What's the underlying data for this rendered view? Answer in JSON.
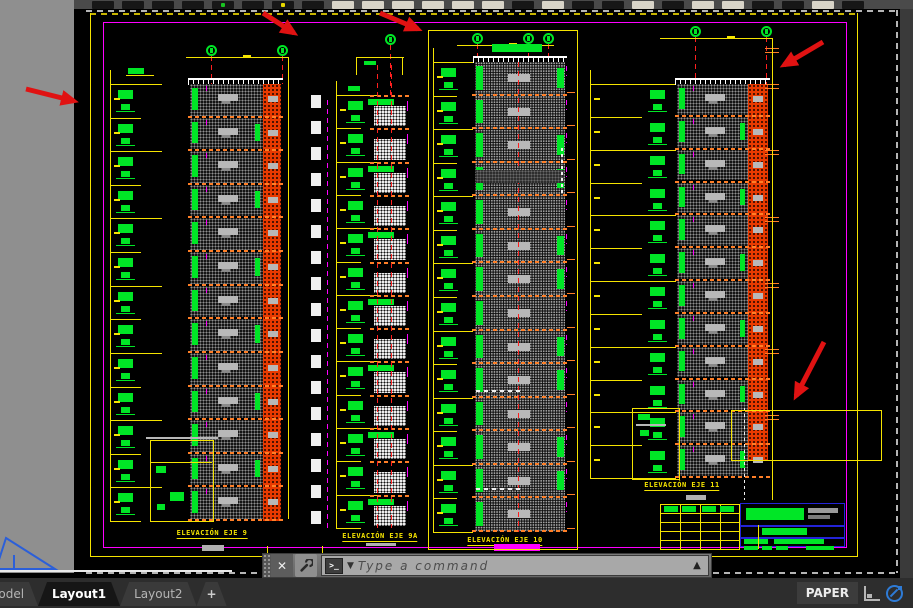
{
  "palette": {
    "yellow": "#f5e400",
    "green": "#00e626",
    "magenta": "#ff00ff",
    "orange": "#ff7f27",
    "red": "#ff1f1f",
    "arrow": "#e01212",
    "blue": "#2323d8",
    "gray_sill": "#b8b8b8",
    "orange_fill": "#e83a00"
  },
  "drawings": [
    {
      "id": "eje9",
      "label": "ELEVACIÓN EJE 9",
      "floors": 13,
      "axis_bubbles": 2
    },
    {
      "id": "eje9a",
      "label": "ELEVACIÓN EJE 9A",
      "floors": 13,
      "axis_bubbles": 1
    },
    {
      "id": "eje10",
      "label": "ELEVACIÓN EJE 10",
      "floors": 14,
      "axis_bubbles": 3
    },
    {
      "id": "eje11",
      "label": "ELEVACIÓN EJE 11",
      "floors": 12,
      "axis_bubbles": 2
    }
  ],
  "annotations": {
    "arrow_count": 5,
    "arrow_color": "#e01212"
  },
  "command_bar": {
    "placeholder": "Type a command",
    "prompt_symbol": ">_",
    "close_symbol": "✕",
    "dropdown_symbol": "▼",
    "expand_symbol": "▲"
  },
  "tabs": [
    {
      "label": "Model",
      "active": false
    },
    {
      "label": "Layout1",
      "active": true
    },
    {
      "label": "Layout2",
      "active": false
    },
    {
      "label": "+",
      "active": false
    }
  ],
  "status_bar": {
    "paper_label": "PAPER"
  }
}
